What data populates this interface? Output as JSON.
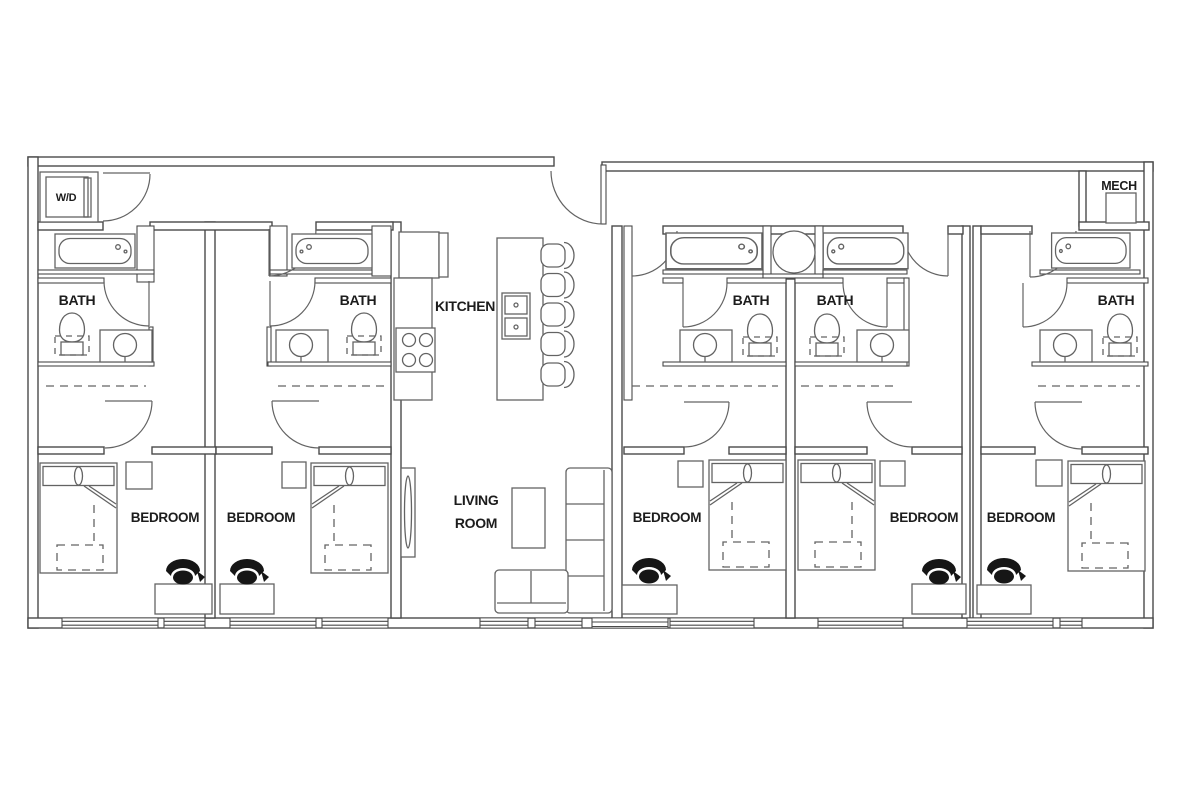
{
  "colors": {
    "wall": "#4a4a4a",
    "fixture": "#636363",
    "label": "#1c1c1c",
    "bg": "#ffffff",
    "chair": "#161616"
  },
  "floor_plan": {
    "laundry_closet": {
      "label": "W/D"
    },
    "mechanical_room": {
      "label": "MECH"
    },
    "kitchen": {
      "label": "KITCHEN"
    },
    "living_room": {
      "label_line1": "LIVING",
      "label_line2": "ROOM"
    },
    "baths": [
      {
        "label": "BATH"
      },
      {
        "label": "BATH"
      },
      {
        "label": "BATH"
      },
      {
        "label": "BATH"
      },
      {
        "label": "BATH"
      }
    ],
    "bedrooms": [
      {
        "label": "BEDROOM"
      },
      {
        "label": "BEDROOM"
      },
      {
        "label": "BEDROOM"
      },
      {
        "label": "BEDROOM"
      },
      {
        "label": "BEDROOM"
      }
    ]
  }
}
